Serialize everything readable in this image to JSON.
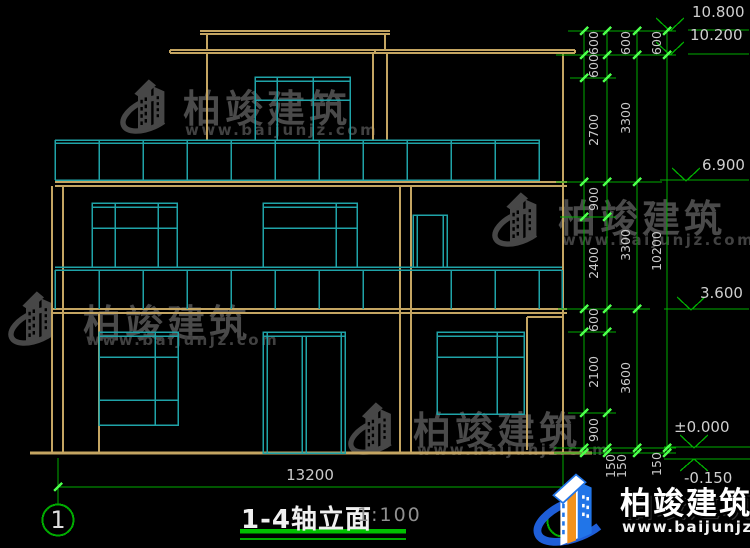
{
  "title": {
    "text": "1-4轴立面",
    "scale": "1:100"
  },
  "axis_bubble": "1",
  "overall_width": "13200",
  "elevations": {
    "e1": "10.800",
    "e2": "10.200",
    "e3": "6.900",
    "e4": "3.600",
    "e5": "±0.000",
    "e6": "-0.150"
  },
  "dim_chains": {
    "inner": [
      "600",
      "600",
      "2700",
      "900",
      "2400",
      "600",
      "2100",
      "900"
    ],
    "middle": [
      "600",
      "3300",
      "3300",
      "3600"
    ],
    "outer": [
      "600",
      "10200"
    ],
    "base": [
      "150",
      "150",
      "150"
    ]
  },
  "watermark": {
    "name": "柏竣建筑",
    "url": "www.baijunjz.com"
  },
  "brand": {
    "name": "柏竣建筑",
    "url": "www.baijunjz.com"
  },
  "colors": {
    "background": "#000000",
    "wall_tan": "#C4A562",
    "window_cyan": "#1FA3A8",
    "dimension_green": "#00AC00",
    "tick_green": "#4CFF4C",
    "text_gray": "#C9C9C9",
    "brand_blue": "#2175E8",
    "brand_orange": "#F2921D"
  }
}
